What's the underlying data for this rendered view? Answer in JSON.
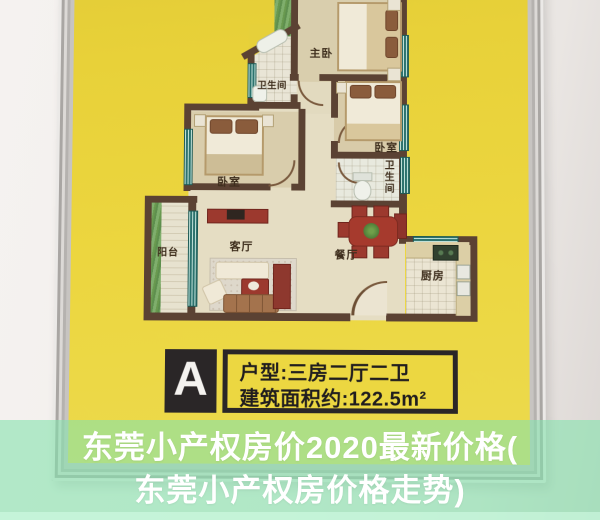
{
  "caption": {
    "line1": "东莞小产权房价2020最新价格(",
    "line2": "东莞小产权房价格走势)"
  },
  "poster": {
    "badge_letter": "A",
    "badge_line1": "户型:三房二厅二卫",
    "badge_line2": "建筑面积约:122.5m²"
  },
  "rooms": {
    "master_bedroom": "主卧",
    "bathroom_top": "卫生间",
    "bedroom_right": "卧室",
    "bathroom_right": "卫生间",
    "bedroom_left": "卧室",
    "balcony": "阳台",
    "living_room": "客厅",
    "dining_room": "餐厅",
    "kitchen": "厨房"
  },
  "colors": {
    "poster_yellow": "#ecd63f",
    "wall_brown": "#5b4233",
    "window_teal": "#2c726d",
    "overlay_green": "#85e2ad",
    "badge_black": "#2a2627",
    "caption_text": "#ffffff"
  }
}
